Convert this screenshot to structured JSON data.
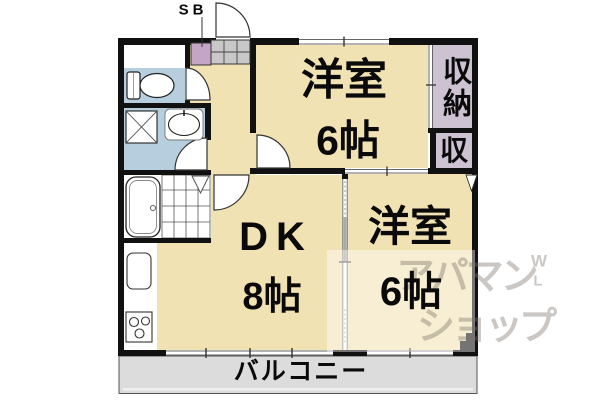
{
  "labels": {
    "sb_label": "SB",
    "room_top": {
      "name": "洋室",
      "size": "6帖"
    },
    "closet_main_label": "収納",
    "closet_small_label": "収",
    "dk": {
      "name": "DK",
      "size": "8帖"
    },
    "room_right": {
      "name": "洋室",
      "size": "6帖"
    },
    "balcony_label": "バルコニー"
  },
  "watermark": {
    "line1": "アパマン",
    "line2": "ショップ",
    "mark_top": "W",
    "mark_bottom": "L"
  },
  "colors": {
    "room_floor": "#F1E2B3",
    "wet_area": "#B7CEDE",
    "closet": "#CDC2D2",
    "shoe_box": "#C4A5C6",
    "entrance_shelf": "#C8C8C8",
    "balcony": "#DCDCDC",
    "wall": "#111111",
    "watermark_text": "rgba(125,115,108,0.40)"
  }
}
